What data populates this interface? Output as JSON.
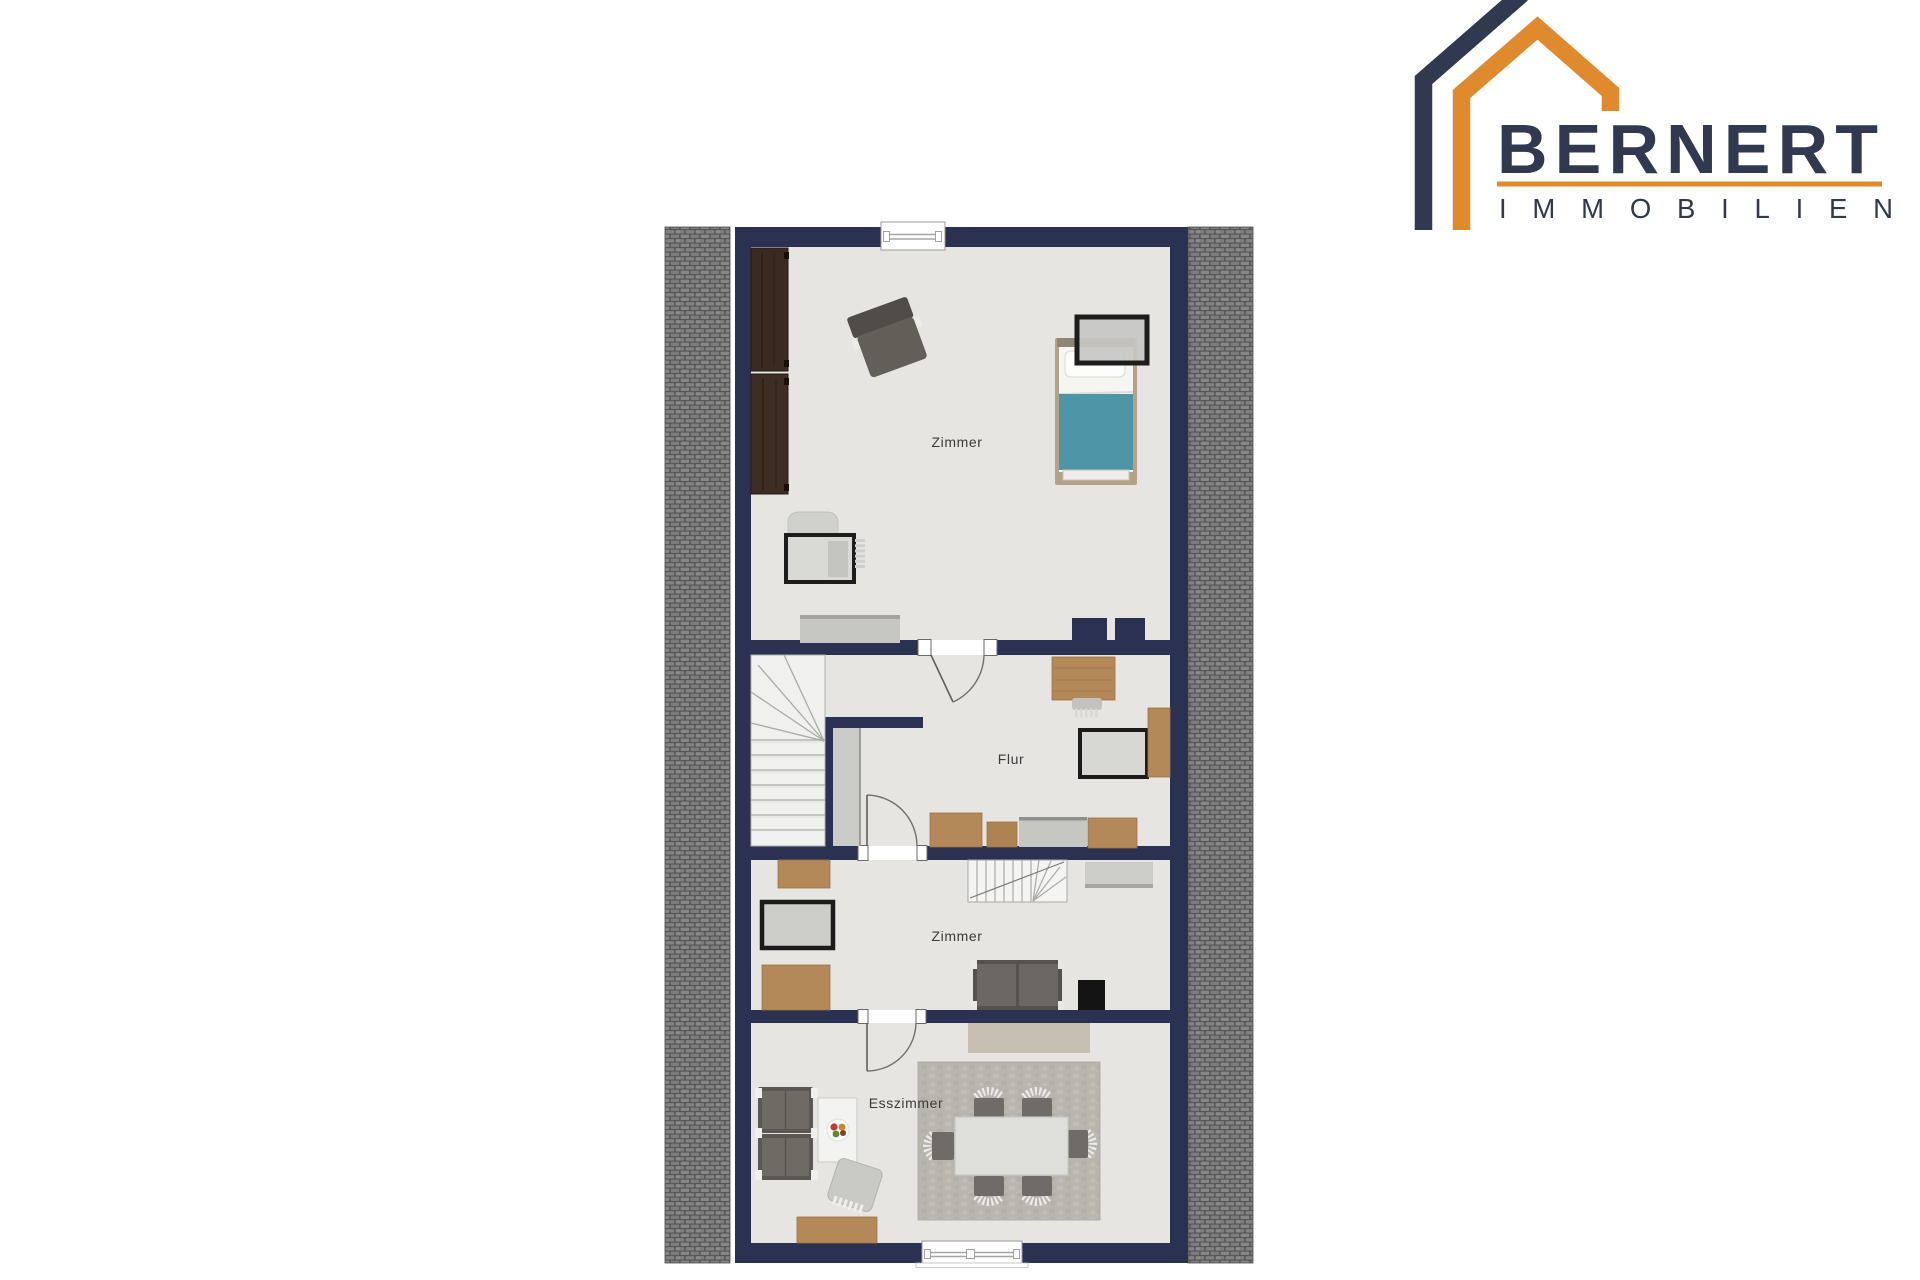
{
  "page": {
    "background": "#ffffff"
  },
  "logo": {
    "brand": "BERNERT",
    "subtitle": "IMMOBILIEN",
    "colors": {
      "navy": "#303950",
      "orange": "#de8a2d"
    }
  },
  "floor_plan": {
    "rooms": {
      "top_room": "Zimmer",
      "hallway": "Flur",
      "middle_room": "Zimmer",
      "dining_room": "Esszimmer"
    },
    "colors": {
      "wall_navy": "#2b3150",
      "floor": "#e6e5e1",
      "roof_tiles": "#7d7d7d",
      "oak_wood": "#b4895a",
      "dark_wood": "#3a2a21",
      "bed_blanket": "#4e95a8",
      "rug_beige": "#c7bfb1",
      "rug_gray": "#b9b6ae"
    }
  }
}
